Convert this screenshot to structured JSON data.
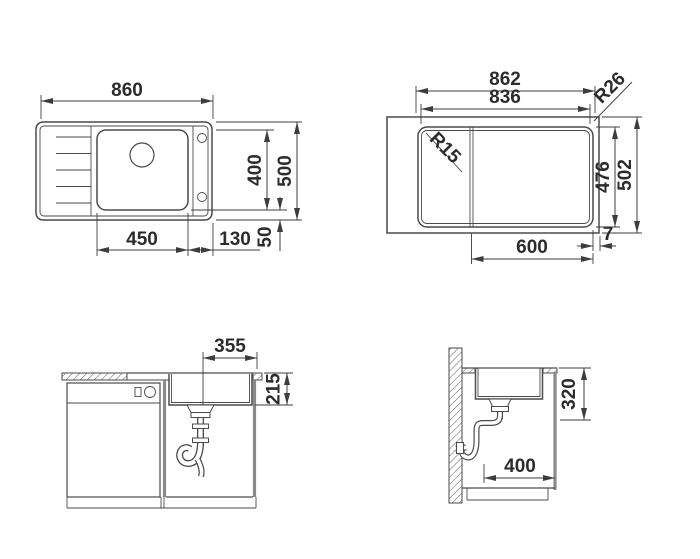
{
  "drawing": {
    "views": {
      "plan": {
        "dim_width": "860",
        "dim_bowl_width": "450",
        "dim_rim_right": "130",
        "dim_rim_offset": "50",
        "dim_bowl_depth": "400",
        "dim_depth": "500"
      },
      "cutout": {
        "dim_outer_width": "862",
        "dim_cutout_width": "836",
        "radius_outer": "R26",
        "radius_cutout": "R15",
        "dim_cutout_depth": "476",
        "dim_outer_depth": "502",
        "dim_cabinet_width": "600",
        "dim_edge_offset": "7"
      },
      "front": {
        "dim_bowl_width": "355",
        "dim_bowl_height": "215"
      },
      "side": {
        "dim_clearance_height": "320",
        "dim_cabinet_depth": "400"
      }
    }
  }
}
